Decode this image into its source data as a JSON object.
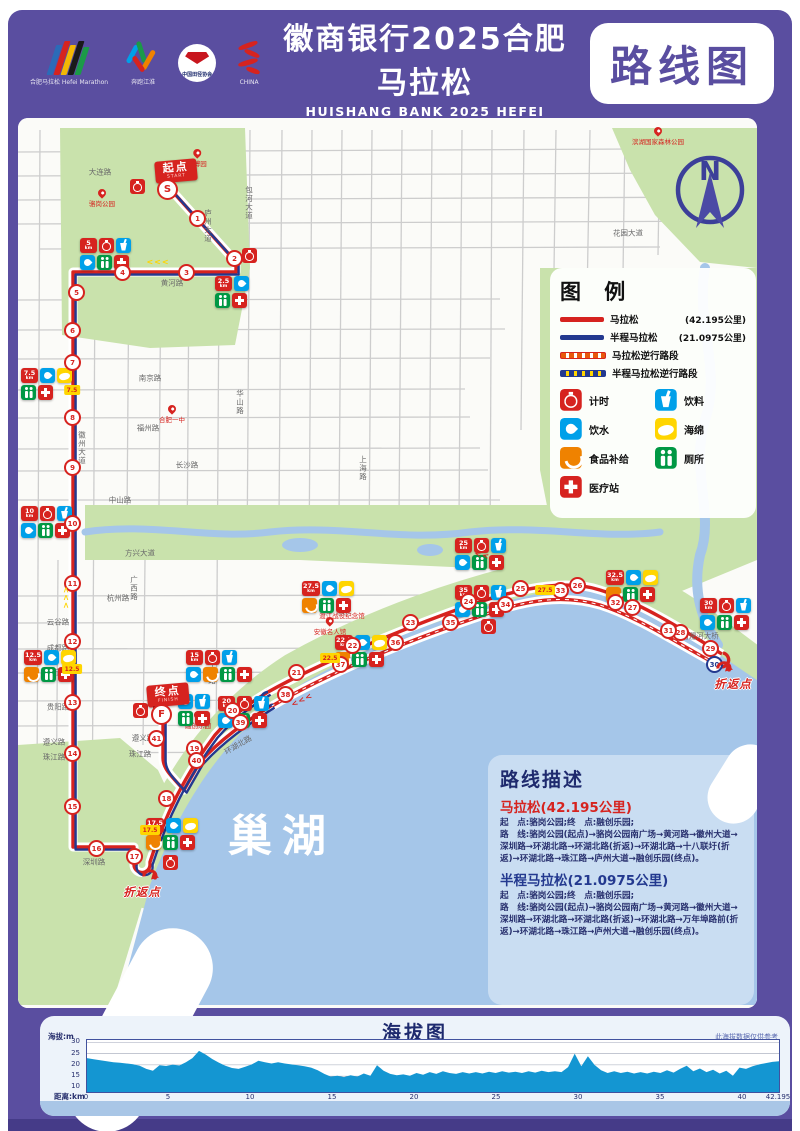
{
  "header": {
    "subtitle": "“奔跑江淮”城市马拉松赛(合肥站)",
    "title": "徽商银行2025合肥马拉松",
    "title_en": "HUISHANG BANK 2025 HEFEI MARATHON",
    "badge": "路线图",
    "logos": [
      {
        "name": "hefei-marathon-logo",
        "label": "合肥马拉松 Hefei Marathon"
      },
      {
        "name": "benpao-jianghuai-logo",
        "label": "奔跑江淮"
      },
      {
        "name": "athletics-association-seal",
        "label": "中国田径协会"
      },
      {
        "name": "china-athletics-logo",
        "label": "CHINA"
      }
    ]
  },
  "legend": {
    "title": "图 例",
    "lines": [
      {
        "swatch": "solid-red",
        "label": "马拉松",
        "note": "(42.195公里)"
      },
      {
        "swatch": "solid-blue",
        "label": "半程马拉松",
        "note": "(21.0975公里)"
      },
      {
        "swatch": "dash-red",
        "label": "马拉松逆行路段",
        "note": ""
      },
      {
        "swatch": "dash-blue",
        "label": "半程马拉松逆行路段",
        "note": ""
      }
    ],
    "icons": [
      {
        "type": "timing",
        "label": "计时"
      },
      {
        "type": "drink",
        "label": "饮料"
      },
      {
        "type": "water",
        "label": "饮水"
      },
      {
        "type": "sponge",
        "label": "海绵"
      },
      {
        "type": "food",
        "label": "食品补给"
      },
      {
        "type": "toilet",
        "label": "厕所"
      },
      {
        "type": "medical",
        "label": "医疗站"
      }
    ]
  },
  "map": {
    "lake_label": "巢湖",
    "north_label": "N",
    "start": {
      "label": "起点",
      "sub": "START",
      "marker": "S",
      "x": 176,
      "y": 182,
      "mx": 167,
      "my": 189
    },
    "finish": {
      "label": "终点",
      "sub": "FINISH",
      "marker": "F",
      "x": 168,
      "y": 706,
      "mx": 161,
      "my": 714
    },
    "turnaround_label": "折返点",
    "turnarounds": [
      {
        "x": 726,
        "y": 666,
        "lx": 733,
        "ly": 676
      },
      {
        "x": 152,
        "y": 874,
        "lx": 142,
        "ly": 884
      }
    ],
    "timers": [
      {
        "x": 137,
        "y": 186
      },
      {
        "x": 249,
        "y": 255
      },
      {
        "x": 488,
        "y": 626
      },
      {
        "x": 170,
        "y": 862
      },
      {
        "x": 140,
        "y": 710
      }
    ],
    "clusters": [
      {
        "km": "2.5",
        "x": 215,
        "y": 276,
        "rows": [
          [
            "b",
            "water"
          ],
          [
            "toilet",
            "medical"
          ]
        ]
      },
      {
        "km": "5",
        "x": 80,
        "y": 238,
        "rows": [
          [
            "b",
            "timing",
            "drink"
          ],
          [
            "water",
            "toilet",
            "medical"
          ]
        ]
      },
      {
        "km": "7.5",
        "x": 21,
        "y": 368,
        "rows": [
          [
            "b",
            "water",
            "sponge"
          ],
          [
            "toilet",
            "medical"
          ]
        ]
      },
      {
        "km": "10",
        "x": 21,
        "y": 506,
        "rows": [
          [
            "b",
            "timing",
            "drink"
          ],
          [
            "water",
            "toilet",
            "medical"
          ]
        ]
      },
      {
        "km": "12.5",
        "x": 24,
        "y": 650,
        "rows": [
          [
            "b",
            "water",
            "sponge"
          ],
          [
            "food",
            "toilet",
            "medical"
          ]
        ]
      },
      {
        "km": "15",
        "x": 186,
        "y": 650,
        "rows": [
          [
            "b",
            "timing",
            "drink"
          ],
          [
            "water",
            "food",
            "toilet",
            "medical"
          ]
        ]
      },
      {
        "km": "17.5",
        "x": 146,
        "y": 818,
        "rows": [
          [
            "b",
            "water",
            "sponge"
          ],
          [
            "food",
            "toilet",
            "medical"
          ]
        ]
      },
      {
        "km": "20",
        "x": 218,
        "y": 696,
        "rows": [
          [
            "b",
            "timing",
            "drink"
          ],
          [
            "water",
            "toilet",
            "medical"
          ]
        ]
      },
      {
        "km": "22.5",
        "x": 335,
        "y": 635,
        "rows": [
          [
            "b",
            "water",
            "sponge"
          ],
          [
            "food",
            "toilet",
            "medical"
          ]
        ]
      },
      {
        "km": "25",
        "x": 455,
        "y": 538,
        "rows": [
          [
            "b",
            "timing",
            "drink"
          ],
          [
            "water",
            "toilet",
            "medical"
          ]
        ]
      },
      {
        "km": "27.5",
        "x": 302,
        "y": 581,
        "rows": [
          [
            "b",
            "water",
            "sponge"
          ],
          [
            "food",
            "toilet",
            "medical"
          ]
        ]
      },
      {
        "km": "30",
        "x": 700,
        "y": 598,
        "rows": [
          [
            "b",
            "timing",
            "drink"
          ],
          [
            "water",
            "toilet",
            "medical"
          ]
        ]
      },
      {
        "km": "32.5",
        "x": 606,
        "y": 570,
        "rows": [
          [
            "b",
            "water",
            "sponge"
          ],
          [
            "food",
            "toilet",
            "medical"
          ]
        ]
      },
      {
        "km": "35",
        "x": 455,
        "y": 585,
        "rows": [
          [
            "b",
            "timing",
            "drink"
          ],
          [
            "water",
            "toilet",
            "medical"
          ]
        ]
      },
      {
        "km": "",
        "x": 178,
        "y": 694,
        "rows": [
          [
            "water",
            "drink"
          ],
          [
            "toilet",
            "medical"
          ]
        ]
      }
    ],
    "markers": [
      {
        "n": "1",
        "x": 197,
        "y": 218
      },
      {
        "n": "2",
        "x": 234,
        "y": 258
      },
      {
        "n": "3",
        "x": 186,
        "y": 272
      },
      {
        "n": "4",
        "x": 122,
        "y": 272
      },
      {
        "n": "5",
        "x": 76,
        "y": 292
      },
      {
        "n": "6",
        "x": 72,
        "y": 330
      },
      {
        "n": "7",
        "x": 72,
        "y": 362
      },
      {
        "n": "8",
        "x": 72,
        "y": 417
      },
      {
        "n": "9",
        "x": 72,
        "y": 467
      },
      {
        "n": "10",
        "x": 72,
        "y": 523
      },
      {
        "n": "11",
        "x": 72,
        "y": 583
      },
      {
        "n": "12",
        "x": 72,
        "y": 641
      },
      {
        "n": "13",
        "x": 72,
        "y": 702
      },
      {
        "n": "14",
        "x": 72,
        "y": 753
      },
      {
        "n": "15",
        "x": 72,
        "y": 806
      },
      {
        "n": "16",
        "x": 96,
        "y": 848
      },
      {
        "n": "17",
        "x": 134,
        "y": 856
      },
      {
        "n": "18",
        "x": 166,
        "y": 798
      },
      {
        "n": "19",
        "x": 194,
        "y": 748
      },
      {
        "n": "20",
        "x": 232,
        "y": 710
      },
      {
        "n": "21",
        "x": 296,
        "y": 672
      },
      {
        "n": "22",
        "x": 352,
        "y": 645
      },
      {
        "n": "23",
        "x": 410,
        "y": 622
      },
      {
        "n": "24",
        "x": 468,
        "y": 601
      },
      {
        "n": "25",
        "x": 520,
        "y": 588
      },
      {
        "n": "26",
        "x": 577,
        "y": 585
      },
      {
        "n": "27",
        "x": 632,
        "y": 607
      },
      {
        "n": "28",
        "x": 680,
        "y": 632
      },
      {
        "n": "29",
        "x": 710,
        "y": 648
      },
      {
        "n": "30",
        "x": 714,
        "y": 664,
        "c": "blue"
      },
      {
        "n": "31",
        "x": 668,
        "y": 630
      },
      {
        "n": "32",
        "x": 615,
        "y": 602
      },
      {
        "n": "33",
        "x": 560,
        "y": 590
      },
      {
        "n": "34",
        "x": 505,
        "y": 604
      },
      {
        "n": "35",
        "x": 450,
        "y": 622
      },
      {
        "n": "36",
        "x": 395,
        "y": 642
      },
      {
        "n": "37",
        "x": 340,
        "y": 664
      },
      {
        "n": "38",
        "x": 285,
        "y": 694
      },
      {
        "n": "39",
        "x": 240,
        "y": 722
      },
      {
        "n": "40",
        "x": 196,
        "y": 760
      },
      {
        "n": "41",
        "x": 156,
        "y": 738
      }
    ],
    "half_flags": [
      {
        "t": "7.5",
        "x": 72,
        "y": 390
      },
      {
        "t": "12.5",
        "x": 72,
        "y": 669
      },
      {
        "t": "17.5",
        "x": 150,
        "y": 830
      },
      {
        "t": "22.5",
        "x": 330,
        "y": 658
      },
      {
        "t": "27.5",
        "x": 545,
        "y": 590
      }
    ],
    "chevrons": [
      {
        "x": 158,
        "y": 262,
        "r": 0,
        "c": "#FFD500"
      },
      {
        "x": 66,
        "y": 598,
        "r": 90,
        "c": "#FFD500"
      },
      {
        "x": 486,
        "y": 556,
        "r": 14,
        "c": "#D6231F"
      },
      {
        "x": 302,
        "y": 700,
        "r": -26,
        "c": "#D6231F"
      }
    ],
    "roads": [
      {
        "t": "大连路",
        "x": 100,
        "y": 172
      },
      {
        "t": "庐州大道",
        "x": 208,
        "y": 226,
        "v": 1
      },
      {
        "t": "花园大道",
        "x": 628,
        "y": 233
      },
      {
        "t": "黄河路",
        "x": 172,
        "y": 283
      },
      {
        "t": "包河大道",
        "x": 249,
        "y": 203,
        "v": 1
      },
      {
        "t": "徽州大道",
        "x": 82,
        "y": 448,
        "v": 1
      },
      {
        "t": "南京路",
        "x": 150,
        "y": 378
      },
      {
        "t": "福州路",
        "x": 148,
        "y": 428
      },
      {
        "t": "华山路",
        "x": 240,
        "y": 402,
        "v": 1
      },
      {
        "t": "长沙路",
        "x": 187,
        "y": 465
      },
      {
        "t": "上海路",
        "x": 363,
        "y": 468,
        "v": 1
      },
      {
        "t": "中山路",
        "x": 120,
        "y": 500
      },
      {
        "t": "方兴大道",
        "x": 140,
        "y": 553
      },
      {
        "t": "广西路",
        "x": 134,
        "y": 588,
        "v": 1
      },
      {
        "t": "杭州路",
        "x": 118,
        "y": 598
      },
      {
        "t": "云谷路",
        "x": 58,
        "y": 622
      },
      {
        "t": "成都路",
        "x": 58,
        "y": 648
      },
      {
        "t": "南宁路",
        "x": 58,
        "y": 672
      },
      {
        "t": "贵阳路",
        "x": 58,
        "y": 707
      },
      {
        "t": "遵义路",
        "x": 54,
        "y": 742
      },
      {
        "t": "遵义路",
        "x": 143,
        "y": 738
      },
      {
        "t": "珠江路",
        "x": 54,
        "y": 757
      },
      {
        "t": "珠江路",
        "x": 140,
        "y": 754
      },
      {
        "t": "深圳路",
        "x": 94,
        "y": 862
      },
      {
        "t": "环湖北路",
        "x": 238,
        "y": 745,
        "r": -30
      },
      {
        "t": "万年埠路",
        "x": 212,
        "y": 668,
        "v": 1
      },
      {
        "t": "南淝河大桥",
        "x": 700,
        "y": 636
      }
    ],
    "pois": [
      {
        "t": "骆岗公园",
        "x": 102,
        "y": 208
      },
      {
        "t": "园博园",
        "x": 197,
        "y": 168
      },
      {
        "t": "合肥一中",
        "x": 172,
        "y": 424
      },
      {
        "t": "渡江战役纪念馆",
        "x": 342,
        "y": 620
      },
      {
        "t": "安徽名人馆",
        "x": 330,
        "y": 636
      },
      {
        "t": "融创乐园",
        "x": 198,
        "y": 730
      },
      {
        "t": "滨湖国家森林公园",
        "x": 658,
        "y": 146
      }
    ]
  },
  "description": {
    "title": "路线描述",
    "sections": [
      {
        "kind": "full",
        "title": "马拉松(42.195公里)",
        "meta": "起　点:骆岗公园;终　点:融创乐园;",
        "route": "路　线:骆岗公园(起点)→骆岗公园南广场→黄河路→徽州大道→深圳路→环湖北路→环湖北路(折返)→环湖北路→十八联圩(折返)→环湖北路→珠江路→庐州大道→融创乐园(终点)。"
      },
      {
        "kind": "half",
        "title": "半程马拉松(21.0975公里)",
        "meta": "起　点:骆岗公园;终　点:融创乐园;",
        "route": "路　线:骆岗公园(起点)→骆岗公园南广场→黄河路→徽州大道→深圳路→环湖北路→环湖北路(折返)→环湖北路→万年埠路前(折返)→环湖北路→珠江路→庐州大道→融创乐园(终点)。"
      }
    ]
  },
  "elevation": {
    "title": "海拔图",
    "note": "此海拔数据仅供参考",
    "y_label": "海拔:m",
    "x_label": "距离:km",
    "y_ticks": [
      30,
      25,
      20,
      15,
      10
    ],
    "x_ticks": [
      0,
      5,
      10,
      15,
      20,
      25,
      30,
      35,
      40,
      42.195
    ]
  },
  "chart_data": {
    "type": "area",
    "title": "海拔图",
    "xlabel": "距离:km",
    "ylabel": "海拔:m",
    "xlim": [
      0,
      42.195
    ],
    "ylim": [
      10,
      30
    ],
    "grid": true,
    "series_name": "海拔",
    "values": [
      23,
      22.5,
      22,
      21.6,
      21.2,
      20.9,
      20.6,
      20.3,
      19.6,
      18.2,
      17.4,
      19.8,
      19.5,
      20.1,
      19.7,
      21.2,
      23.0,
      26.2,
      24.6,
      22.6,
      21.0,
      19.6,
      18.6,
      18.2,
      19.2,
      20.2,
      21.8,
      21.2,
      20.6,
      21.2,
      20.6,
      20.2,
      19.8,
      19.4,
      18.8,
      17.6,
      16.0,
      14.8,
      15.2,
      14.6,
      15.4,
      14.8,
      16.2,
      15.2,
      19.8,
      17.4,
      16.0,
      15.4,
      15.8,
      15.2,
      16.4,
      15.6,
      16.8,
      16.0,
      17.2,
      16.4,
      16.0,
      16.8,
      16.2,
      16.8,
      16.2,
      17.0,
      16.4,
      17.2,
      16.6,
      17.0,
      16.4,
      17.2,
      16.6,
      17.4,
      16.8,
      17.2,
      16.8,
      19.0,
      25.0,
      19.4,
      23.8,
      20.0,
      17.6,
      16.4,
      17.2,
      16.4,
      17.0,
      16.2,
      16.8,
      16.2,
      17.0,
      16.4,
      17.6,
      16.6,
      18.2,
      19.6,
      17.2,
      18.4,
      16.8,
      17.8,
      16.2,
      17.4,
      15.2,
      18.8,
      18.2,
      19.4,
      20.2,
      20.8,
      21.3,
      21.6
    ]
  }
}
